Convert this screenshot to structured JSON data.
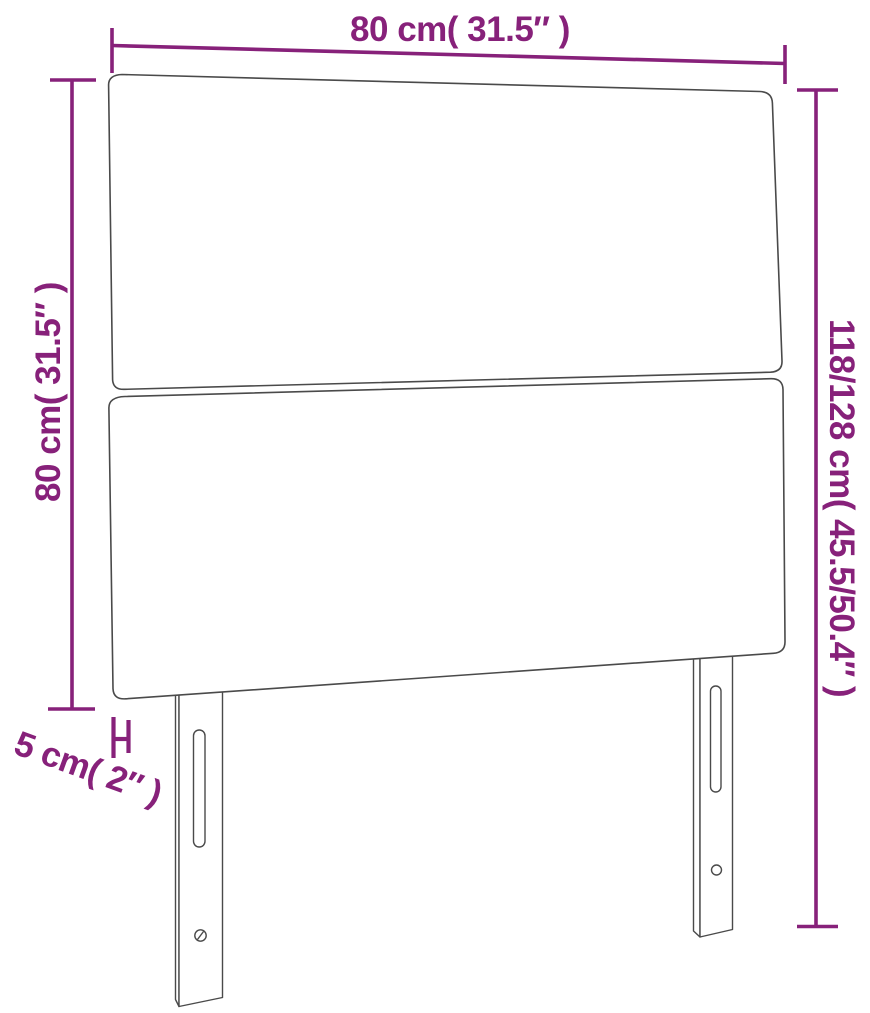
{
  "diagram": {
    "type": "product-dimension-diagram",
    "subject": "headboard-front-view",
    "colors": {
      "dimension": "#87217a",
      "outline": "#4a4a4a",
      "background": "#ffffff"
    },
    "dimensions": {
      "width": {
        "label": "80 cm( 31.5″ )"
      },
      "panel_height": {
        "label": "80 cm( 31.5″ )"
      },
      "total_height": {
        "label": "118/128 cm( 45.5/50.4″ )"
      },
      "thickness": {
        "label": "5 cm( 2″ )"
      }
    }
  }
}
